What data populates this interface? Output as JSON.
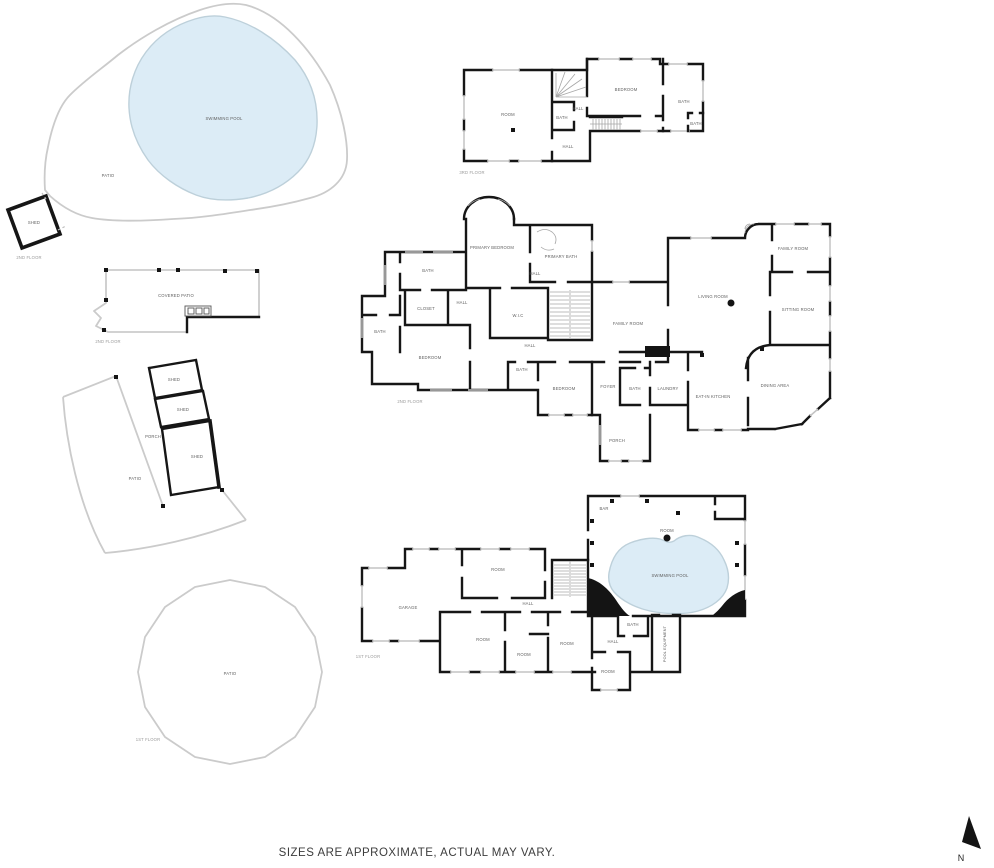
{
  "footer": {
    "disclaimer": "SIZES ARE APPROXIMATE, ACTUAL MAY VARY.",
    "north_label": "N"
  },
  "colors": {
    "wall": "#161616",
    "patio_outline": "#cbcbcb",
    "pool_fill": "#dcecf6",
    "pool_stroke": "#bdd0da",
    "room_label": "#5f5f5f",
    "floor_label": "#9a9a9a"
  },
  "pool_site": {
    "swimming_pool": "SWIMMING POOL",
    "patio": "PATIO",
    "shed": "SHED",
    "floor_label": "2ND FLOOR"
  },
  "covered_patio": {
    "label": "COVERED PATIO",
    "floor_label": "2ND FLOOR"
  },
  "porch_area": {
    "patio": "PATIO",
    "porch": "PORCH",
    "shed_top": "SHED",
    "shed_middle": "SHED",
    "shed_bottom": "SHED"
  },
  "round_patio": {
    "label": "PATIO",
    "floor_label": "1ST FLOOR"
  },
  "floor3": {
    "floor_label": "3RD FLOOR",
    "rooms": {
      "room": "ROOM",
      "bath_a": "BATH",
      "hall_a": "HALL",
      "bedroom": "BEDROOM",
      "bath_b": "BATH",
      "bath_c": "BATH",
      "hall_b": "HALL"
    }
  },
  "floor2": {
    "floor_label": "2ND FLOOR",
    "rooms": {
      "primary_bedroom": "PRIMARY BEDROOM",
      "primary_bath": "PRIMARY BATH",
      "hall_a": "HALL",
      "bath_a": "BATH",
      "closet": "CLOSET",
      "bath_b": "BATH",
      "bedroom_a": "BEDROOM",
      "hall_b": "HALL",
      "wic": "W.I.C",
      "hall_c": "HALL",
      "bath_c": "BATH",
      "bedroom_b": "BEDROOM",
      "family_room_a": "FAMILY ROOM",
      "living_room": "LIVING ROOM",
      "family_room_b": "FAMILY ROOM",
      "sitting_room": "SITTING ROOM",
      "dining_area": "DINING AREA",
      "eat_in_kitchen": "EAT-IN KITCHEN",
      "laundry": "LAUNDRY",
      "bath_d": "BATH",
      "foyer": "FOYER",
      "porch": "PORCH"
    }
  },
  "floor1": {
    "floor_label": "1ST FLOOR",
    "rooms": {
      "garage": "GARAGE",
      "room_a": "ROOM",
      "hall_a": "HALL",
      "room_b": "ROOM",
      "room_c": "ROOM",
      "room_d": "ROOM",
      "bar": "BAR",
      "room_e": "ROOM",
      "swimming_pool": "SWIMMING POOL",
      "bath": "BATH",
      "hall_b": "HALL",
      "room_f": "ROOM",
      "pool_equipment": "POOL EQUIPMENT"
    }
  }
}
